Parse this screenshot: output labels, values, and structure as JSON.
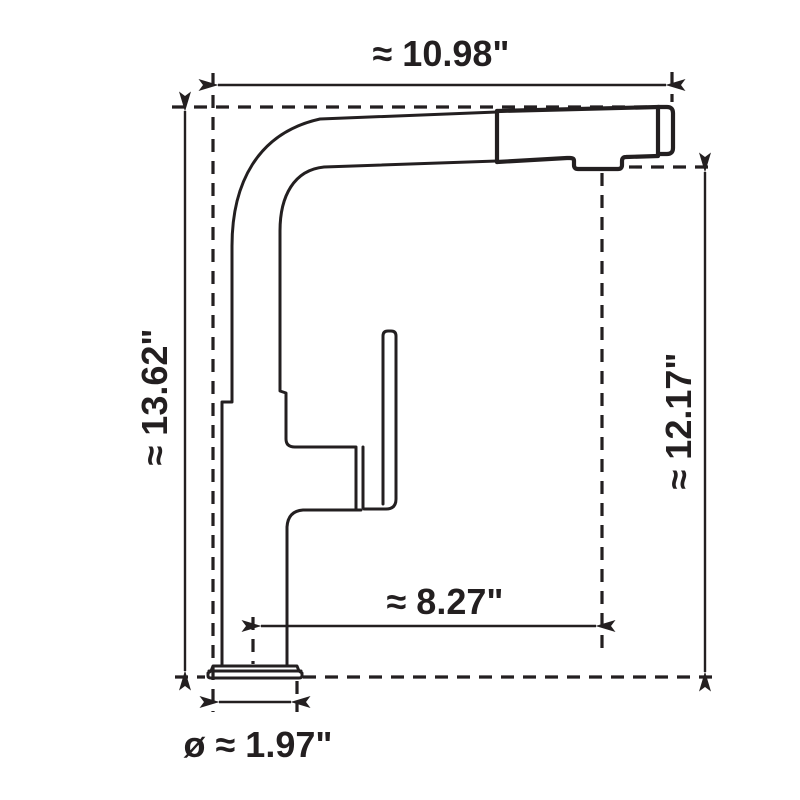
{
  "diagram": {
    "background_color": "#ffffff",
    "line_color": "#231f20",
    "dimensions": {
      "overall_width": "≈ 10.98\"",
      "overall_height": "≈ 13.62\"",
      "spout_outlet_height": "≈ 12.17\"",
      "spout_reach": "≈ 8.27\"",
      "base_diameter": "ø ≈ 1.97\""
    }
  }
}
